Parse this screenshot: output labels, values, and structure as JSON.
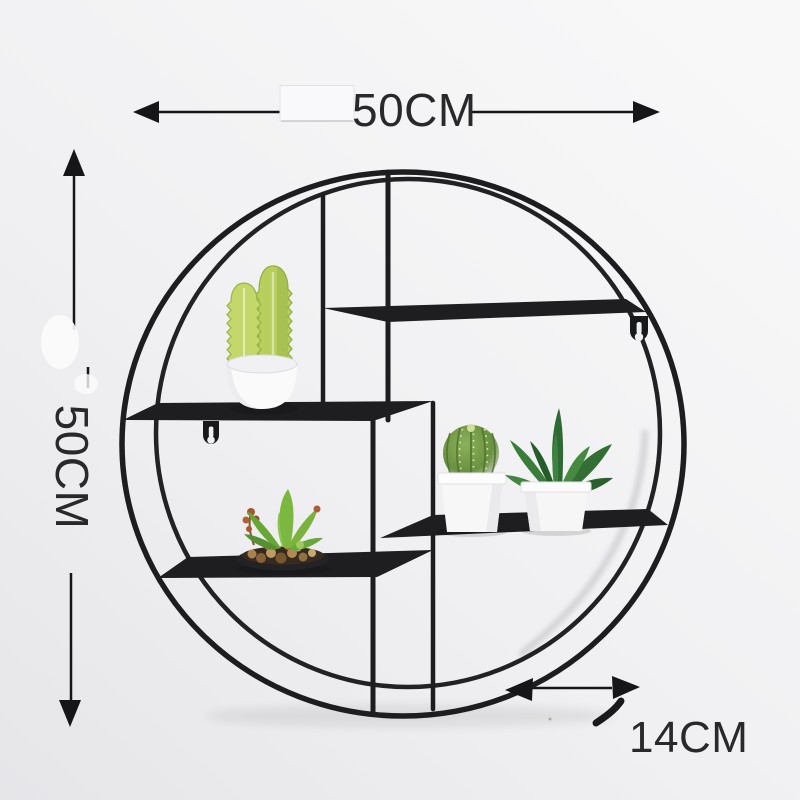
{
  "image": {
    "kind": "product dimension photo",
    "subject": "round metal wall-mounted shelf with faux plants"
  },
  "annotations": {
    "width": {
      "label": "50CM",
      "orientation": "horizontal",
      "position": "top"
    },
    "height": {
      "label": "50CM",
      "orientation": "vertical",
      "position": "left"
    },
    "depth": {
      "label": "14CM",
      "orientation": "horizontal",
      "position": "bottom-right"
    }
  },
  "shelf": {
    "shape": "circle",
    "rings": 2,
    "tiers": 4,
    "mounting": "keyhole tabs",
    "plants": [
      {
        "name": "columnar cactus",
        "container": "white round pot",
        "tier": "upper-left"
      },
      {
        "name": "succulent arrangement",
        "container": "black dish with pebbles",
        "tier": "lower-left"
      },
      {
        "name": "ball cactus",
        "container": "white square pot",
        "tier": "lower-right"
      },
      {
        "name": "agave",
        "container": "white square pot",
        "tier": "lower-right"
      }
    ]
  },
  "palette": {
    "wall": "#f1f1f3",
    "frame": "#1d1d1f",
    "annotation_text": "#29292b",
    "pot_white": "#f7f7f8",
    "cactus_green": "#bcd35f",
    "succulent_green": "#7cb83f",
    "ball_cactus_green": "#6b9140",
    "agave_green": "#2f6b33",
    "pebble_brown": "#a9814f"
  }
}
